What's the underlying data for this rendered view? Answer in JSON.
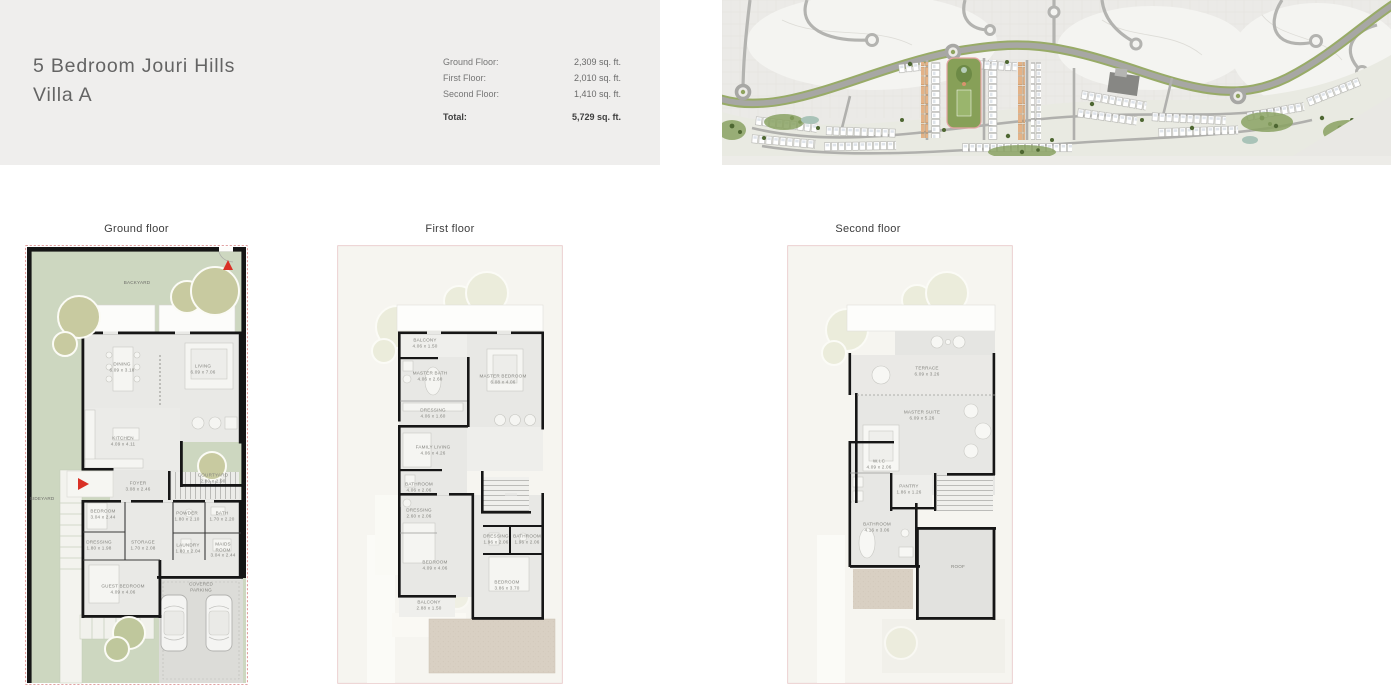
{
  "header": {
    "title_line1": "5 Bedroom Jouri Hills",
    "title_line2": "Villa A",
    "areas": [
      {
        "label": "Ground Floor:",
        "value": "2,309 sq. ft."
      },
      {
        "label": "First Floor:",
        "value": "2,010 sq. ft."
      },
      {
        "label": "Second Floor:",
        "value": "1,410 sq. ft."
      }
    ],
    "total": {
      "label": "Total:",
      "value": "5,729 sq. ft."
    }
  },
  "site_map": {
    "description": "Jouri Hills community master plan"
  },
  "plans": [
    {
      "label": "Ground floor",
      "rooms": {
        "backyard": "BACKYARD",
        "sideyard": "SIDEYARD",
        "dining": "DINING\n6.09 x 3.18",
        "living": "LIVING\n6.09 x 7.06",
        "kitchen": "KITCHEN\n4.09 x 4.11",
        "courtyard": "COURTYARD\n2.80 x 2.90",
        "foyer": "FOYER\n3.08 x 2.46",
        "bedroom": "BEDROOM\n3.04 x 2.44",
        "dressing": "DRESSING\n1.80 x 1.98",
        "storage": "STORAGE\n1.70 x 2.08",
        "powder": "POWDER\n1.80 x 2.10",
        "bath": "BATH\n1.70 x 2.20",
        "laundry": "LAUNDRY\n1.80 x 2.04",
        "maids": "MAIDS ROOM\n3.04 x 2.44",
        "guest_bedroom": "GUEST BEDROOM\n4.09 x 4.06",
        "parking": "COVERED PARKING"
      }
    },
    {
      "label": "First floor",
      "rooms": {
        "balcony_master": "BALCONY\n4.06 x 1.50",
        "master_bath": "MASTER BATH\n4.06 x 2.60",
        "master_bedroom": "MASTER BEDROOM\n6.08 x 4.06",
        "dressing_master": "DRESSING\n4.06 x 1.60",
        "family_living": "FAMILY LIVING\n4.06 x 4.26",
        "bathroom_2": "BATHROOM\n4.06 x 2.06",
        "dressing_2": "DRESSING\n2.60 x 2.06",
        "bedroom_2": "BEDROOM\n4.09 x 4.06",
        "balcony_2": "BALCONY\n2.88 x 1.50",
        "dressing_3": "DRESSING\n1.96 x 2.06",
        "bathroom_3": "BATHROOM\n1.96 x 2.06",
        "bedroom_3": "BEDROOM\n3.86 x 3.70"
      }
    },
    {
      "label": "Second floor",
      "rooms": {
        "terrace": "TERRACE\n6.09 x 3.26",
        "master_suite": "MASTER SUITE\n6.09 x 5.26",
        "wic": "W.I.C\n4.09 x 2.06",
        "pantry": "PANTRY\n1.86 x 1.26",
        "bathroom": "BATHROOM\n4.16 x 3.06",
        "roof": "ROOF"
      }
    }
  ],
  "colors": {
    "header_band": "#efeeed",
    "title_text": "#646464",
    "accent_red": "#d93025",
    "yard_green": "#cdd7c0",
    "tree_olive": "#c8caa0",
    "plan_floor_gray": "#e8e8e5",
    "terrace_beige": "#d9d0c3",
    "map_road_gray": "#a7a7a4",
    "map_green": "#98ab67",
    "park_green": "#87a058"
  }
}
